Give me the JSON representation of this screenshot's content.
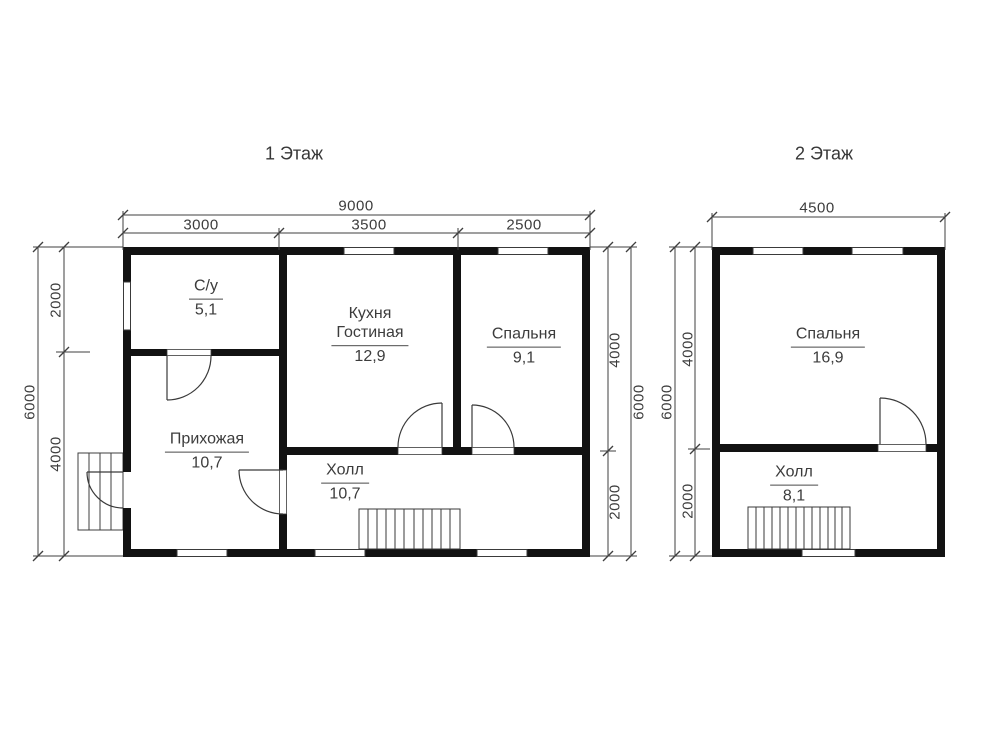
{
  "floor1": {
    "title": "1 Этаж",
    "rooms": {
      "su": {
        "name": "С/у",
        "area": "5,1"
      },
      "kitchen": {
        "line1": "Кухня",
        "line2": "Гостиная",
        "area": "12,9"
      },
      "bedroom": {
        "name": "Спальня",
        "area": "9,1"
      },
      "entry": {
        "name": "Прихожая",
        "area": "10,7"
      },
      "hall": {
        "name": "Холл",
        "area": "10,7"
      }
    },
    "dims": {
      "width_total": "9000",
      "w1": "3000",
      "w2": "3500",
      "w3": "2500",
      "height_total_left": "6000",
      "left_top": "2000",
      "left_bottom": "4000",
      "right_top": "4000",
      "right_bottom": "2000",
      "height_total_right": "6000"
    }
  },
  "floor2": {
    "title": "2 Этаж",
    "rooms": {
      "bedroom": {
        "name": "Спальня",
        "area": "16,9"
      },
      "hall": {
        "name": "Холл",
        "area": "8,1"
      }
    },
    "dims": {
      "width_total": "4500",
      "height_total": "6000",
      "left_top": "4000",
      "left_bottom": "2000"
    }
  },
  "colors": {
    "wall": "#121212",
    "thin_line": "#3f3f3f",
    "text": "#3c3c3c",
    "background": "#ffffff"
  }
}
